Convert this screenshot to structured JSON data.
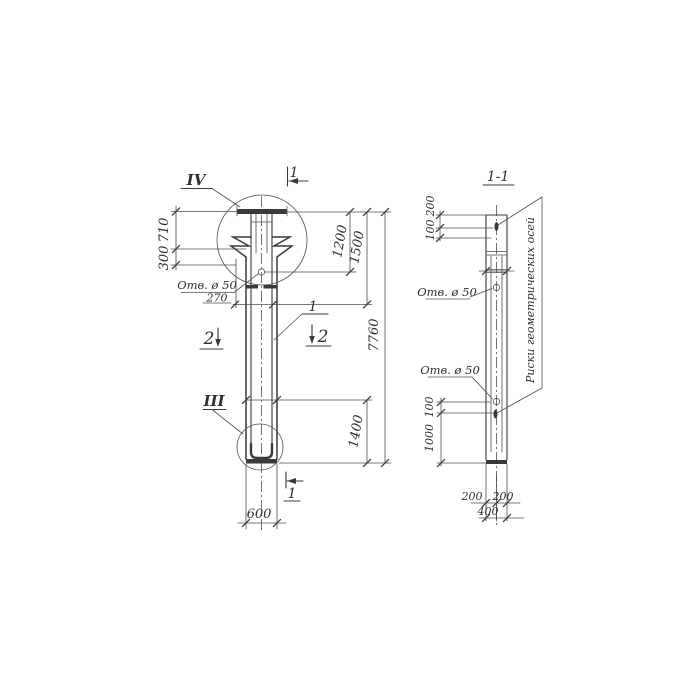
{
  "left_view": {
    "detail_circle_top": "IV",
    "detail_circle_bottom": "III",
    "section_cut_top": "1",
    "section_cut_bottom": "1",
    "section_cut_left": "2",
    "section_cut_right": "2",
    "part_callout": "1",
    "hole_note": "Отв. ø 50",
    "dim_710": "710",
    "dim_300": "300",
    "dim_270": "270",
    "dim_1200": "1200",
    "dim_1500": "1500",
    "dim_7760": "7760",
    "dim_1400": "1400",
    "dim_600": "600"
  },
  "section_view": {
    "title": "1-1",
    "hole_note_upper": "Отв. ø 50",
    "hole_note_lower": "Отв. ø 50",
    "axes_note": "Риски геометрических осей",
    "dim_200_top": "200",
    "dim_100_top": "100",
    "dim_100_bottom": "100",
    "dim_1000": "1000",
    "dim_200_left": "200",
    "dim_200_right": "200",
    "dim_400": "400"
  },
  "colors": {
    "ink": "#3a3a3a",
    "paper": "#ffffff"
  }
}
